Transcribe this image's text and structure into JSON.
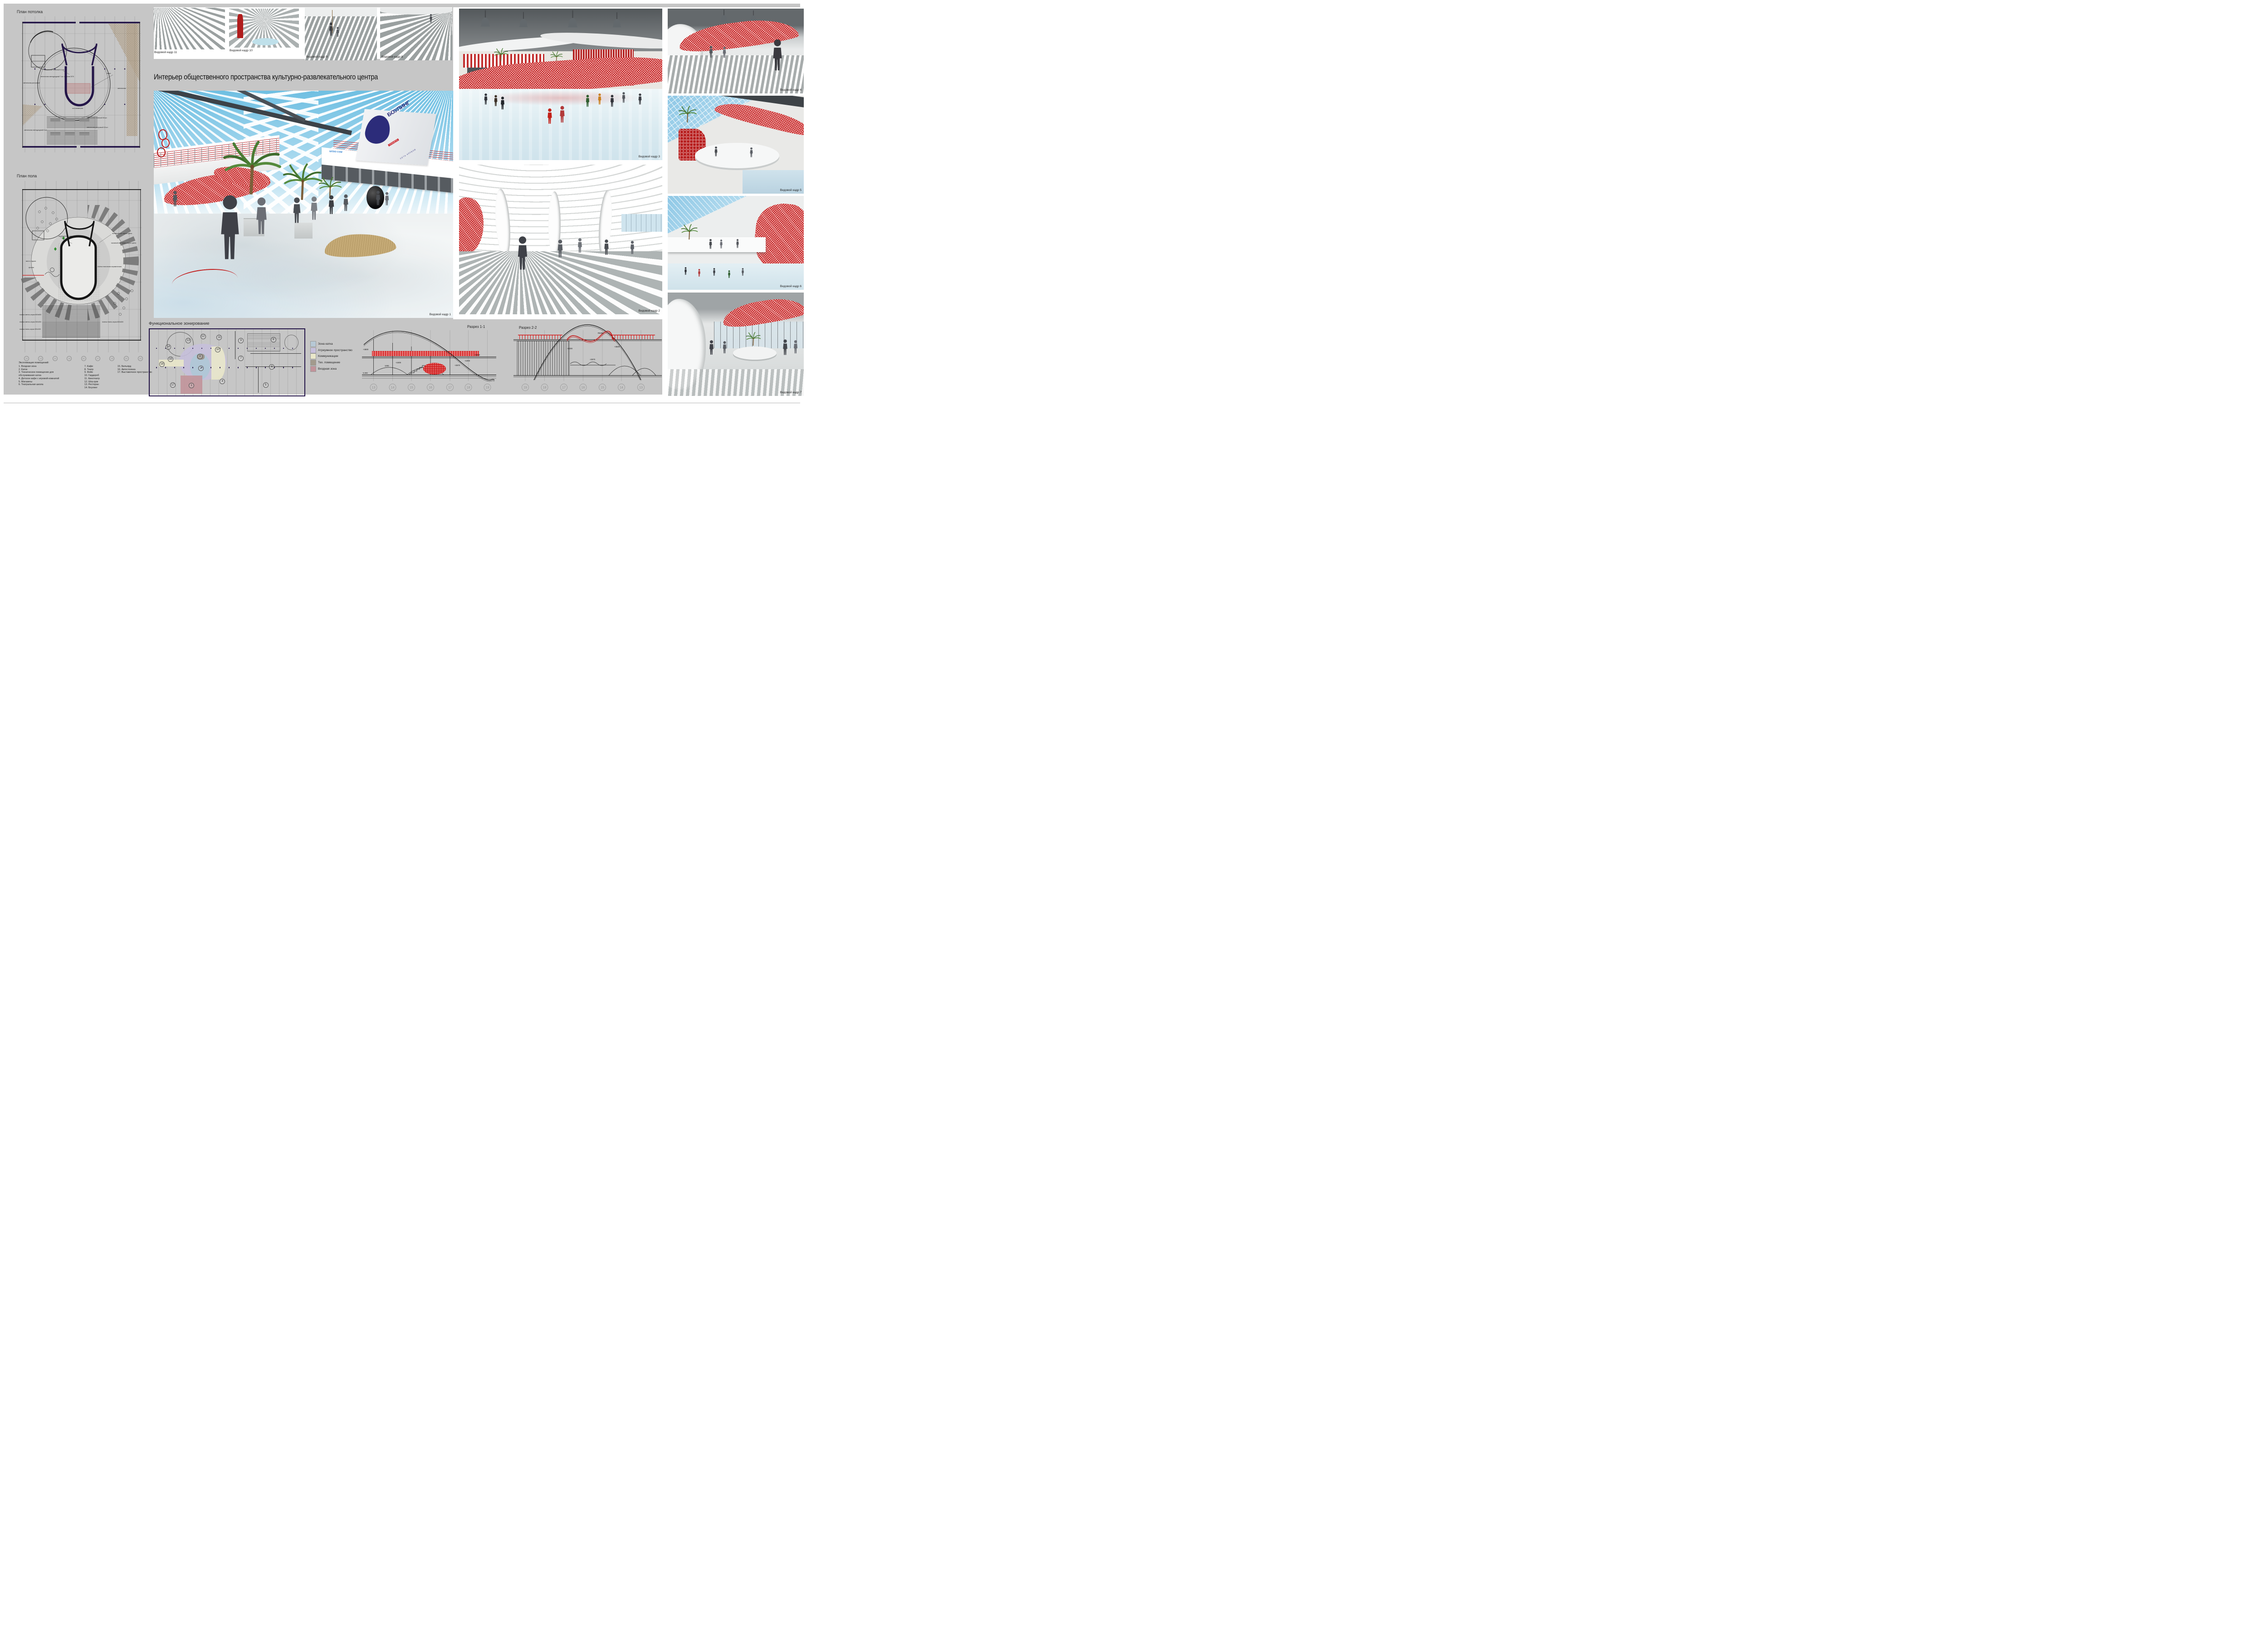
{
  "title": "Интерьер общественного пространства культурно-развлекательного центра",
  "plans": {
    "ceiling": {
      "label": "План потолка",
      "ann": [
        "светильник точечный 11 шт.",
        "светильник светодиодный 7 шт. с шагом 2370",
        "светильник растровый",
        "навес",
        "светильник точечный 36 шт.",
        "светильник светодиодный 6 шт.",
        "светильник растровый 18 шт.",
        "ось симметрии",
        "светильник"
      ]
    },
    "floor": {
      "label": "План пола",
      "ann": [
        "наливной пол светло-серого цвета",
        "наливной пол серого цвета",
        "наливной пол темно-серого цвета",
        "плитка напольная керамическая",
        "место отдыха",
        "фонтан",
        "плитка светло-серая 600х600",
        "плитка светло-серая 300х300",
        "плитка темно-серая 300х300",
        "плитка темно-серая 600х600"
      ],
      "grid": [
        "12",
        "13",
        "14",
        "15",
        "16",
        "17",
        "18",
        "19",
        "20"
      ]
    },
    "explication": {
      "title": "Экспликация помещений:",
      "col1": [
        "1. Входная зона",
        "2. Каток",
        "3. Техническое помещение для обслуживания катка",
        "4. Детское кафе с игровой комнатой",
        "5. Магазины",
        "6. Театральная школа"
      ],
      "col2": [
        "7. Кафе",
        "8. Театр",
        "9. Фойе",
        "10. Гардероб",
        "11. Кинотеатр",
        "12. Шоу-рум",
        "13. Ресторан",
        "14. Боулинг"
      ],
      "col3": [
        "15. Бильярд",
        "16. Автостоянка",
        "17. Выставочное пространство"
      ]
    }
  },
  "views": {
    "v1": "Видовой кадр 1",
    "v2": "Видовой кадр 2",
    "v3": "Видовой кадр 3",
    "v4": "Видовой кадр 4",
    "v5": "Видовой кадр 5",
    "v6": "Видовой кадр 6",
    "v7": "Видовой кадр 7",
    "v8": "Видовой кадр 8",
    "v9": "Видовой кадр 9",
    "v10": "Видовой кадр 10",
    "v11": "Видовой кадр 11"
  },
  "zoning": {
    "label": "Функциональное зонирование",
    "legend": [
      {
        "label": "Зона катка",
        "color": "#b7c9d5"
      },
      {
        "label": "Атриумное пространство",
        "color": "#c6bfdc"
      },
      {
        "label": "Коммуникации",
        "color": "#eae8ca"
      },
      {
        "label": "Тех. помещение",
        "color": "#a29a8c"
      },
      {
        "label": "Входная зона",
        "color": "#c2939a"
      }
    ],
    "numbers": [
      "1",
      "2",
      "3",
      "4",
      "5",
      "6",
      "7",
      "8",
      "9",
      "10",
      "11",
      "12",
      "13",
      "14",
      "15",
      "16",
      "17"
    ]
  },
  "sections": {
    "s1": {
      "label": "Разрез 1-1",
      "grid": [
        "13",
        "14",
        "15",
        "16",
        "17",
        "18",
        "19"
      ],
      "dims": [
        "+4500",
        "0.000",
        "1200",
        "+2400",
        "+2670",
        "+1000",
        "+3500"
      ]
    },
    "s2": {
      "label": "Разрез 2-2",
      "grid": [
        "19",
        "18",
        "17",
        "16",
        "15",
        "14",
        "13"
      ],
      "dims": [
        "+1000",
        "+2670",
        "+3500",
        "R9458"
      ]
    }
  },
  "signs": {
    "bowling_top": "БОУЛИНГ",
    "bowling_mid": "ПЛАНЕТА",
    "bowling_bottom": "СЕТЬ КЛУБОВ",
    "nitro": "NITRO COM",
    "insider": "in-Sider"
  },
  "colors": {
    "board": "#c6c6c6",
    "accent_red": "#c41414",
    "wall_navy": "#241548",
    "sky_blue": "#79c4e4",
    "ice": "#dfeef4"
  }
}
